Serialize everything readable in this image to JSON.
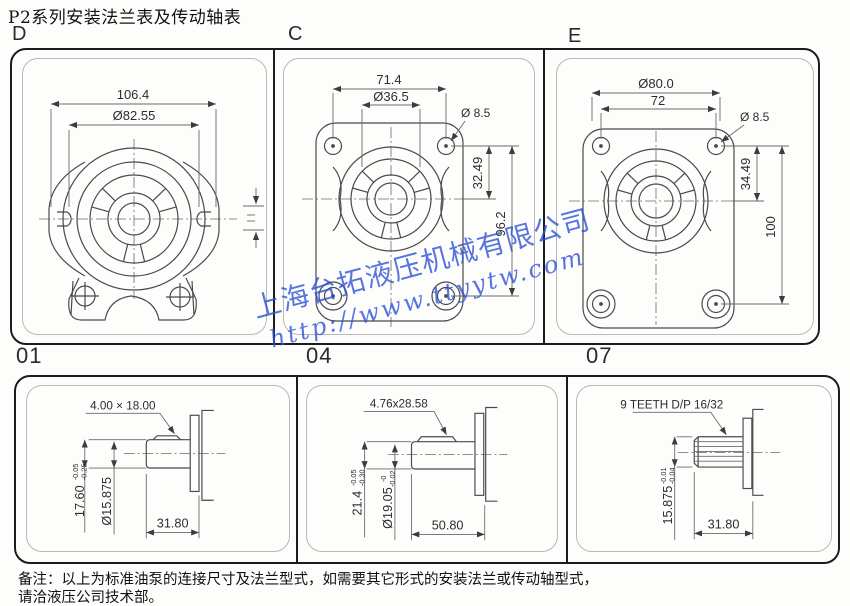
{
  "page": {
    "title": "P2系列安装法兰表及传动轴表"
  },
  "note": {
    "line1": "备注：以上为标准油泵的连接尺寸及法兰型式，如需要其它形式的安装法兰或传动轴型式，",
    "line2": "请洽液压公司技术部。"
  },
  "watermark": {
    "company": "上海台拓液压机械有限公司",
    "url": "http://www.ttyytw.com",
    "color": "#2b50d6"
  },
  "flanges": {
    "d": {
      "label": "D",
      "dim_width": "106.4",
      "dim_bolt_circle": "Ø82.55"
    },
    "c": {
      "label": "C",
      "dim_width": "71.4",
      "dim_pilot": "Ø36.5",
      "dim_hole": "Ø 8.5",
      "dim_offset": "32.49",
      "dim_height": "96.2"
    },
    "e": {
      "label": "E",
      "dim_bolt_circle": "Ø80.0",
      "dim_width": "72",
      "dim_hole": "Ø 8.5",
      "dim_offset": "34.49",
      "dim_height": "100"
    }
  },
  "shafts": {
    "s01": {
      "label": "01",
      "key_size": "4.00 × 18.00",
      "flat_height": "17.60",
      "flat_tol_top": "-0.05",
      "flat_tol_bottom": "-0.25",
      "diameter": "Ø15.875",
      "length": "31.80"
    },
    "s04": {
      "label": "04",
      "key_size": "4.76x28.58",
      "flat_height": "21.4",
      "flat_tol_top": "-0.05",
      "flat_tol_bottom": "-0.30",
      "diameter": "Ø19.05",
      "dia_tol_top": "-0",
      "dia_tol_bottom": "-0.02",
      "length": "50.80"
    },
    "s07": {
      "label": "07",
      "spline": "9 TEETH D/P 16/32",
      "diameter": "15.875",
      "dia_tol_top": "-0.01",
      "dia_tol_bottom": "-0.04",
      "length": "31.80"
    }
  }
}
